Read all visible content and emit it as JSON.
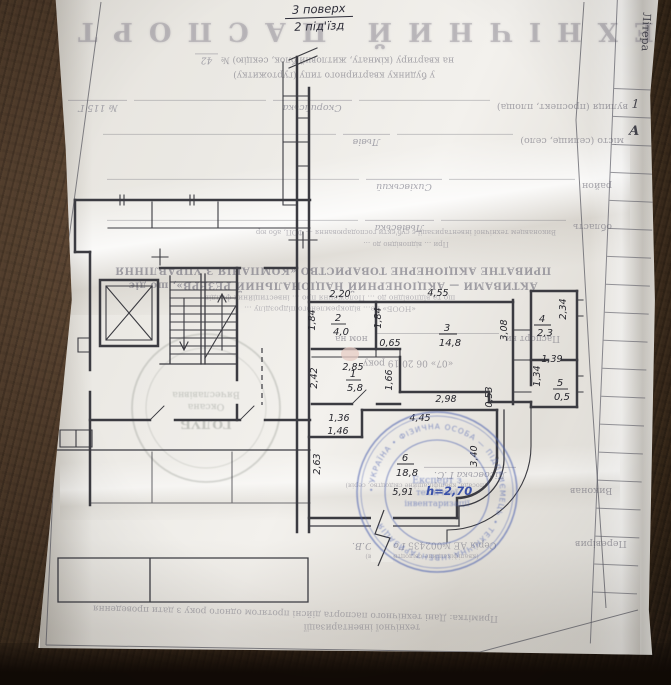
{
  "handnote": {
    "floor": "3 поверх",
    "entrance": "2 під'їзд"
  },
  "back": {
    "title": "ТЕХНІЧНИЙ ПАСПОРТ",
    "apt_label": "на квартиру (кімнату, житловий блок, секцію) №",
    "apt_no": "42",
    "bld_line": "у будинку квартирного типу (гуртожитку)",
    "street_label": "вулиця (проспект, площа)",
    "street_value": "Скорийська",
    "house_no": "№ 115 Г",
    "city_label": "місто (селище, село)",
    "city_value": "Львів",
    "district_label": "район",
    "district_value": "Сихівський",
    "region_label": "область",
    "region_value": "Львівська",
    "exec_small1": "Виконавцем технічної інвентаризації є суб'єкти господарювання — ФОП, або юр",
    "exec_small2": "При … відповідно до …",
    "company1": "ПРИВАТНЕ АКЦІОНЕРНЕ ТОВАРИСТВО «КОМПАНІЯ З УПРАВЛІННЯ",
    "company2": "АКТИВАМИ — АКЦІОНЕРНИЙ НАЦІОНАЛЬНИЙ РЕЗЕРВ», що діє",
    "company3": "що та відповідно до … Положення про … інвестиційних фондів",
    "company4": "«НООБ» не… відокремленого підрозділу …",
    "passport_a": "Паспорт ви",
    "passport_b": "ном на",
    "date_line": "«07»   06   20 19 року",
    "vykonav_label": "Виконав",
    "vykonav_name": "Лісовська Г.С.",
    "vykonav_note": "(посада, кваліфікаційне свідоцтво, серія)",
    "pereviryv_label": "Перевірив",
    "pereviryv_name": "Голуб О.В.",
    "cert": "Серія АЕ №002435",
    "pereviryv_note": "(кваліфікаційне свідоцтво, серія)",
    "note1": "Примітка: Дані технічного паспорта дійсні протягом одного року з дати проведення",
    "note2": "технічної інвентаризації"
  },
  "side_table": {
    "header": "Літера",
    "r1": "1",
    "r2": "А"
  },
  "plan": {
    "rooms": [
      {
        "n": "1",
        "a": "5,8"
      },
      {
        "n": "2",
        "a": "4,0"
      },
      {
        "n": "3",
        "a": "14,8"
      },
      {
        "n": "4",
        "a": "2,3"
      },
      {
        "n": "5",
        "a": "0,5"
      },
      {
        "n": "6",
        "a": "18,8"
      }
    ],
    "dims": [
      "2,20",
      "1,84",
      "1,84",
      "4,55",
      "2,34",
      "3,08",
      "0,65",
      "2,85",
      "2,42",
      "1,66",
      "1,39",
      "1,34",
      "2,98",
      "0,53",
      "4,45",
      "1,36",
      "1,46",
      "2,63",
      "3,40",
      "5,91"
    ],
    "height": "h=2,70"
  },
  "stamps": {
    "left": {
      "l1": "ГОЛУБ",
      "l2": "Оксана",
      "l3": "Вячеславівна"
    },
    "blue": {
      "ring": "• УКРАЇНА • ФІЗИЧНА ОСОБА — ПІДПРИЄМЕЦЬ • ТЕХНІЧНА ІНВЕНТАРИЗАЦІЯ",
      "c1": "Експерт з",
      "c2": "технічної",
      "c3": "інвентаризації"
    }
  }
}
